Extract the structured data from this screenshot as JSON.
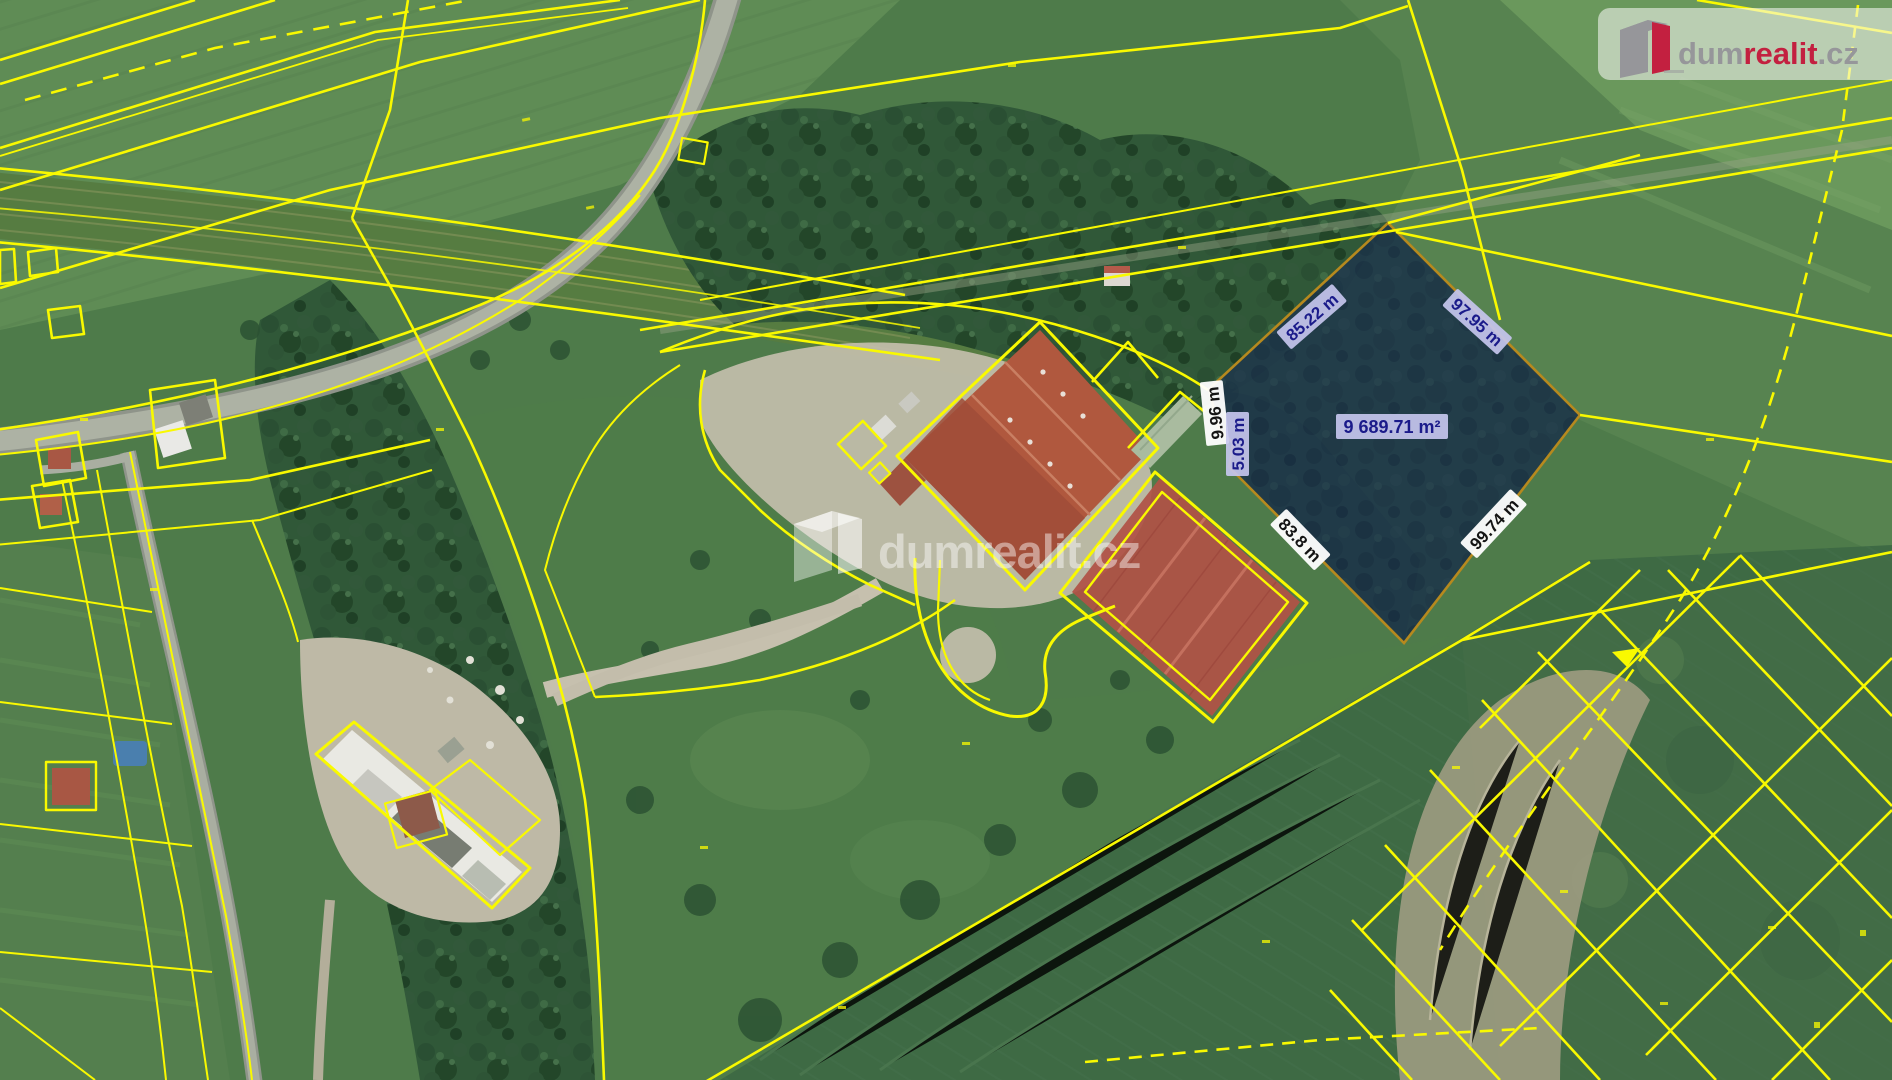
{
  "map": {
    "highlighted_parcel": {
      "area_label": "9 689.71 m²",
      "edges": {
        "nw": "85.22 m",
        "ne": "97.95 m",
        "w_upper": "9.96 m",
        "w_lower": "5.03 m",
        "sw": "83.8 m",
        "se": "99.74 m"
      }
    }
  },
  "branding": {
    "logo_dum": "dum",
    "logo_realit": "realit",
    "logo_cz": ".cz",
    "watermark_text": "dumrealit.cz"
  },
  "colors": {
    "cadastral_line": "#f9f900",
    "parcel_overlay": "#1b2d66",
    "parcel_border": "#b6891e",
    "label_lavender_bg": "#c6c6ee",
    "label_navy_text": "#1b1b8a",
    "label_white_bg": "#ffffff",
    "brand_red": "#c32040",
    "brand_gray": "#96969a"
  }
}
